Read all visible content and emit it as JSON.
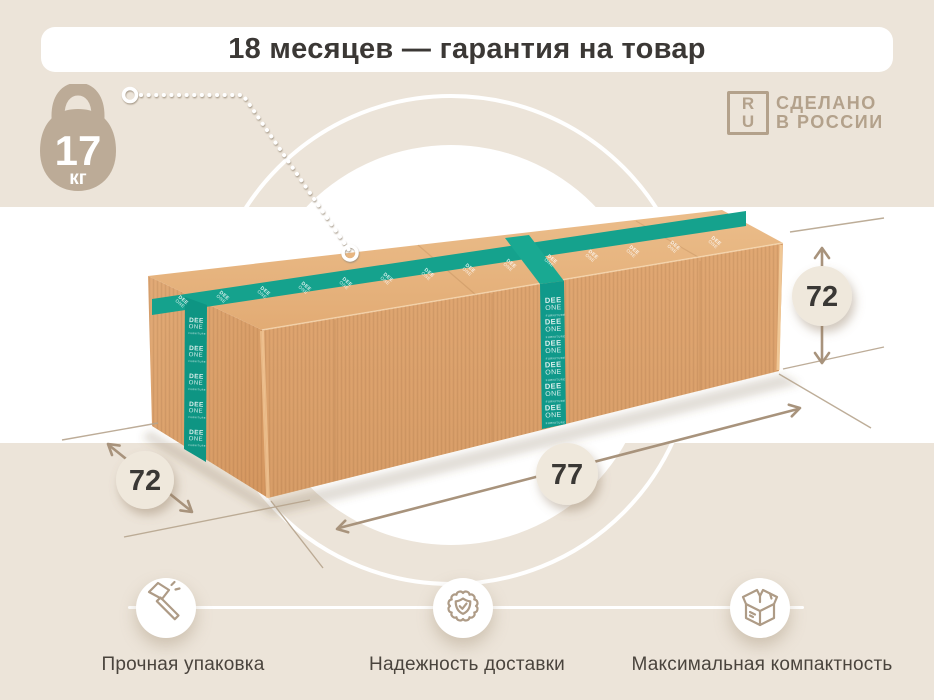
{
  "banner": {
    "title": "18 месяцев — гарантия на товар"
  },
  "weight_badge": {
    "value": "17",
    "unit": "кг"
  },
  "made_in_russia_logo": {
    "frame_top": "R",
    "frame_bottom": "U",
    "line1": "СДЕЛАНО",
    "line2": "В РОССИИ"
  },
  "dimensions": {
    "height_cm": "72",
    "depth_cm": "72",
    "length_cm": "77"
  },
  "tape_brand": {
    "line1": "DEE",
    "line2": "ONE",
    "line3": "FURNITURE"
  },
  "features": [
    {
      "icon": "hammer-icon",
      "label": "Прочная упаковка"
    },
    {
      "icon": "seal-check-icon",
      "label": "Надежность доставки"
    },
    {
      "icon": "package-box-icon",
      "label": "Максимальная компактность"
    }
  ],
  "colors": {
    "background": "#ECE4D9",
    "panel_white": "#FFFFFF",
    "accent_tan": "#B5A28B",
    "dimension_line": "#A8937C",
    "tape_teal": "#12A08B",
    "cardboard": "#DFA46F",
    "text_dark": "#3B3835"
  }
}
